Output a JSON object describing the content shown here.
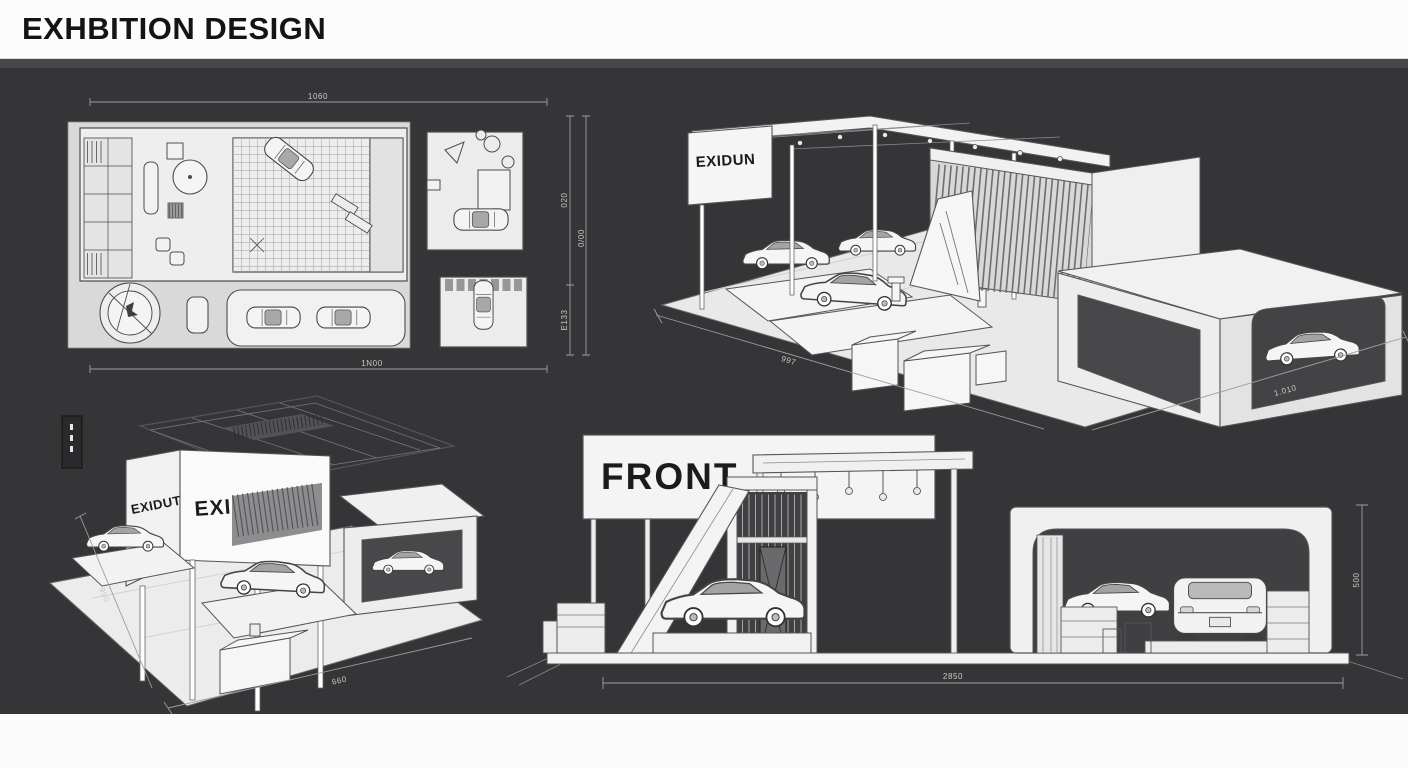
{
  "header": {
    "title": "EXHBITION DESIGN"
  },
  "floor_plan": {
    "dim_top": "1060",
    "dim_bottom": "1N00",
    "dim_right_upper": "020",
    "dim_right_lower": "E133",
    "dim_right_outer": "0/00"
  },
  "iso_back": {
    "sign": "EXIDUN",
    "dim_left": "997",
    "dim_right": "1.010"
  },
  "iso_front": {
    "sign_left": "EXIDUT",
    "sign_front": "EXIDUN",
    "dim_left": "990",
    "dim_bottom": "660"
  },
  "elevation": {
    "sign": "FRONT",
    "dim_bottom": "2850",
    "dim_right": "500"
  },
  "colors": {
    "canvas_bg": "#353537",
    "paper": "#f2f2f2",
    "opening_dark": "#404042",
    "line": "#4d4d4f",
    "dimension": "#c9c9c9"
  }
}
